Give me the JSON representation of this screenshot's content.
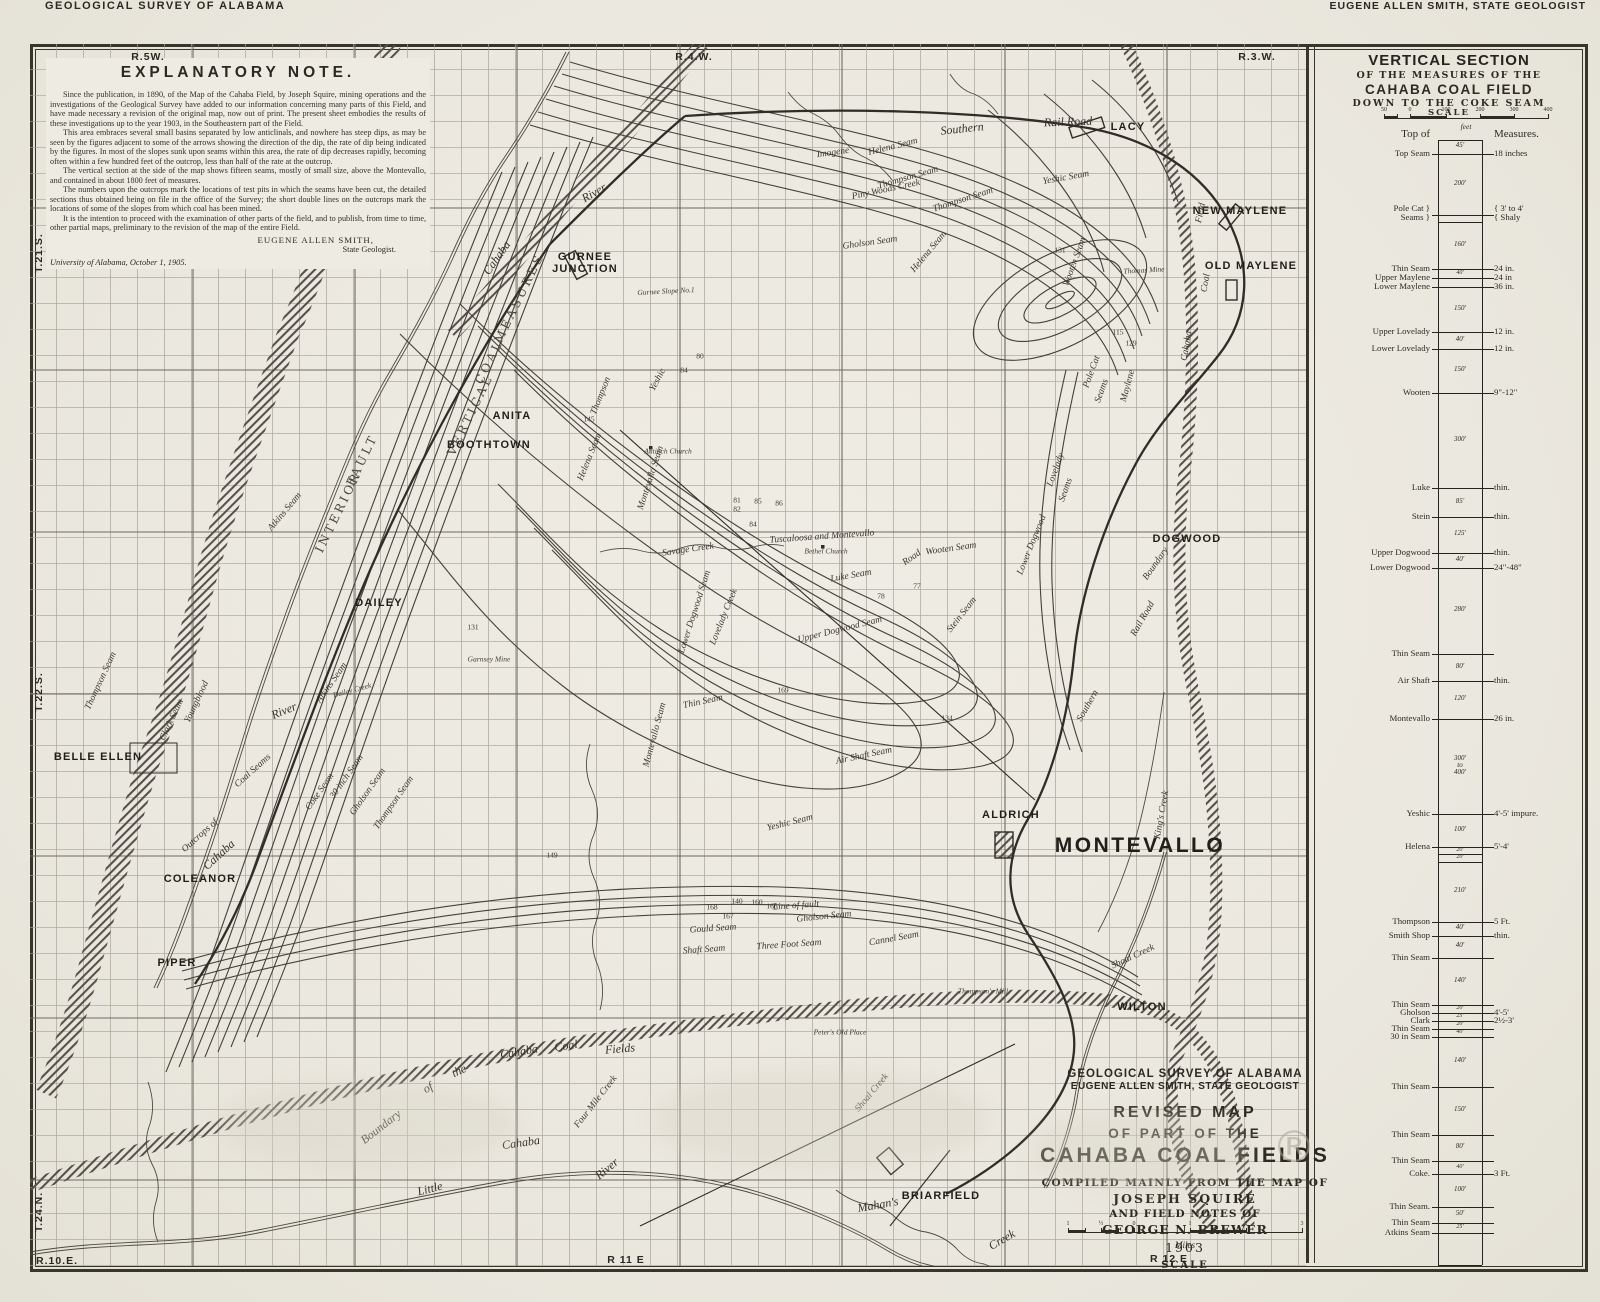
{
  "header": {
    "left": "GEOLOGICAL SURVEY OF ALABAMA",
    "right": "EUGENE ALLEN SMITH, STATE GEOLOGIST"
  },
  "explanatory_note": {
    "title": "EXPLANATORY NOTE.",
    "paragraphs": [
      "Since the publication, in 1890, of the Map of the Cahaba Field, by Joseph Squire, mining operations and the investigations of the Geological Survey have added to our information concerning many parts of this Field, and have made necessary a revision of the original map, now out of print.  The present sheet embodies the results of these investigations up to the year 1903, in the Southeastern part of the Field.",
      "This area embraces several small basins separated by low anticlinals, and nowhere has steep dips, as may be seen by the figures adjacent to some of the arrows showing the direction of the dip, the rate of dip being indicated by the figures.  In most of the slopes sunk upon seams within this area, the rate of dip decreases rapidly, becoming often within a few hundred feet of the outcrop, less than half of the rate at the outcrop.",
      "The vertical section at the side of the map shows fifteen seams, mostly of small size, above the Montevallo, and contained in about 1800 feet of measures.",
      "The numbers upon the outcrops mark the locations of test pits in which the seams have been cut, the detailed sections thus obtained being on file in the office of the Survey; the short double lines on the outcrops mark the locations of some of the slopes from which coal has been mined.",
      "It is the intention to proceed with the examination of other parts of the field, and to publish, from time to time, other partial maps, preliminary to the revision of the map of the entire Field."
    ],
    "signature": "EUGENE ALLEN SMITH,",
    "signature_title": "State Geologist.",
    "dateline": "University of Alabama, October 1, 1905."
  },
  "margin_labels": [
    {
      "t": "R.5W.",
      "x": 148,
      "y": 57,
      "r": 0
    },
    {
      "t": "R.4.W.",
      "x": 694,
      "y": 57,
      "r": 0
    },
    {
      "t": "R.3.W.",
      "x": 1257,
      "y": 57,
      "r": 0
    },
    {
      "t": "T.21.S.",
      "x": 39,
      "y": 253,
      "r": -90
    },
    {
      "t": "T.22.S.",
      "x": 39,
      "y": 692,
      "r": -90
    },
    {
      "t": "T.24.N.",
      "x": 39,
      "y": 1212,
      "r": -90
    },
    {
      "t": "R.10.E.",
      "x": 57,
      "y": 1261,
      "r": 0
    },
    {
      "t": "R 11 E",
      "x": 626,
      "y": 1260,
      "r": 0
    },
    {
      "t": "R 12 E",
      "x": 1169,
      "y": 1259,
      "r": 0
    }
  ],
  "towns": [
    {
      "t": "LACY",
      "x": 1128,
      "y": 127
    },
    {
      "t": "NEW MAYLENE",
      "x": 1240,
      "y": 211
    },
    {
      "t": "OLD MAYLENE",
      "x": 1251,
      "y": 266
    },
    {
      "t": "GURNEE\nJUNCTION",
      "x": 585,
      "y": 263
    },
    {
      "t": "ANITA",
      "x": 512,
      "y": 416
    },
    {
      "t": "BOOTHTOWN",
      "x": 489,
      "y": 445
    },
    {
      "t": "DAILEY",
      "x": 379,
      "y": 603
    },
    {
      "t": "BELLE ELLEN",
      "x": 98,
      "y": 757
    },
    {
      "t": "COLEANOR",
      "x": 200,
      "y": 879
    },
    {
      "t": "PIPER",
      "x": 177,
      "y": 963
    },
    {
      "t": "DOGWOOD",
      "x": 1187,
      "y": 539
    },
    {
      "t": "ALDRICH",
      "x": 1011,
      "y": 815
    },
    {
      "t": "MONTEVALLO",
      "x": 1140,
      "y": 846,
      "lg": true
    },
    {
      "t": "WILTON",
      "x": 1142,
      "y": 1007
    },
    {
      "t": "BRIARFIELD",
      "x": 941,
      "y": 1196
    }
  ],
  "features": [
    {
      "t": "Cahaba",
      "x": 497,
      "y": 258,
      "r": -55,
      "c": "il"
    },
    {
      "t": "River",
      "x": 594,
      "y": 193,
      "r": -30,
      "c": "il"
    },
    {
      "t": "Southern",
      "x": 962,
      "y": 129,
      "r": -6,
      "c": "il"
    },
    {
      "t": "Rail Road",
      "x": 1068,
      "y": 122,
      "r": -2,
      "c": "il"
    },
    {
      "t": "Helena Seam",
      "x": 893,
      "y": 147,
      "r": -14,
      "c": "i"
    },
    {
      "t": "Imogene",
      "x": 833,
      "y": 153,
      "r": -8,
      "c": "i"
    },
    {
      "t": "Thompson Seam",
      "x": 908,
      "y": 178,
      "r": -16,
      "c": "i"
    },
    {
      "t": "Piny Woods Creek",
      "x": 886,
      "y": 190,
      "r": -12,
      "c": "i"
    },
    {
      "t": "Yeshic Seam",
      "x": 1066,
      "y": 178,
      "r": -10,
      "c": "i"
    },
    {
      "t": "Thompson Seam",
      "x": 963,
      "y": 200,
      "r": -18,
      "c": "i"
    },
    {
      "t": "Helena Seam",
      "x": 929,
      "y": 252,
      "r": -50,
      "c": "i"
    },
    {
      "t": "Gholson Seam",
      "x": 870,
      "y": 243,
      "r": -8,
      "c": "i"
    },
    {
      "t": "Yeshic",
      "x": 658,
      "y": 380,
      "r": -62,
      "c": "i"
    },
    {
      "t": "Thompson",
      "x": 601,
      "y": 396,
      "r": -68,
      "c": "i"
    },
    {
      "t": "Helena Seam",
      "x": 590,
      "y": 457,
      "r": -68,
      "c": "i"
    },
    {
      "t": "Montevallo Seam",
      "x": 651,
      "y": 478,
      "r": -72,
      "c": "i"
    },
    {
      "t": "VERTICAL",
      "x": 470,
      "y": 415,
      "r": -64,
      "c": "cap"
    },
    {
      "t": "COAL",
      "x": 489,
      "y": 362,
      "r": -64,
      "c": "cap"
    },
    {
      "t": "MEASURES",
      "x": 519,
      "y": 298,
      "r": -64,
      "c": "cap"
    },
    {
      "t": "INTERIOR",
      "x": 338,
      "y": 512,
      "r": -64,
      "c": "cap"
    },
    {
      "t": "FAULT",
      "x": 362,
      "y": 460,
      "r": -64,
      "c": "cap"
    },
    {
      "t": "Tuscaloosa and Montevallo",
      "x": 822,
      "y": 537,
      "r": -4,
      "c": "i"
    },
    {
      "t": "Road",
      "x": 912,
      "y": 558,
      "r": -35,
      "c": "i"
    },
    {
      "t": "Savage Creek",
      "x": 688,
      "y": 550,
      "r": -8,
      "c": "i"
    },
    {
      "t": "Bethel Church",
      "x": 826,
      "y": 551,
      "r": 0,
      "c": "tn"
    },
    {
      "t": "Antioch Church",
      "x": 668,
      "y": 451,
      "r": 0,
      "c": "tn"
    },
    {
      "t": "Luke Seam",
      "x": 851,
      "y": 576,
      "r": -10,
      "c": "i"
    },
    {
      "t": "Wooten Seam",
      "x": 951,
      "y": 549,
      "r": -8,
      "c": "i"
    },
    {
      "t": "Stein Seam",
      "x": 962,
      "y": 615,
      "r": -52,
      "c": "i"
    },
    {
      "t": "Upper Dogwood Seam",
      "x": 840,
      "y": 630,
      "r": -14,
      "c": "i"
    },
    {
      "t": "Lower Dogwood Seam",
      "x": 695,
      "y": 612,
      "r": -72,
      "c": "i"
    },
    {
      "t": "Lovelady Creek",
      "x": 724,
      "y": 617,
      "r": -68,
      "c": "i"
    },
    {
      "t": "Montevallo Seam",
      "x": 655,
      "y": 735,
      "r": -75,
      "c": "i"
    },
    {
      "t": "Thin Seam",
      "x": 703,
      "y": 702,
      "r": -12,
      "c": "i"
    },
    {
      "t": "Air Shaft Seam",
      "x": 864,
      "y": 756,
      "r": -12,
      "c": "i"
    },
    {
      "t": "Yeshic Seam",
      "x": 790,
      "y": 823,
      "r": -14,
      "c": "i"
    },
    {
      "t": "King's Creek",
      "x": 1162,
      "y": 815,
      "r": -80,
      "c": "i"
    },
    {
      "t": "Shoal Creek",
      "x": 1133,
      "y": 957,
      "r": -25,
      "c": "i"
    },
    {
      "t": "Shoal Creek",
      "x": 872,
      "y": 1093,
      "r": -50,
      "c": "i"
    },
    {
      "t": "Mahan's",
      "x": 878,
      "y": 1205,
      "r": -10,
      "c": "il"
    },
    {
      "t": "Creek",
      "x": 1002,
      "y": 1240,
      "r": -30,
      "c": "il"
    },
    {
      "t": "Boundary",
      "x": 381,
      "y": 1127,
      "r": -38,
      "c": "il"
    },
    {
      "t": "of",
      "x": 428,
      "y": 1088,
      "r": -30,
      "c": "il"
    },
    {
      "t": "the",
      "x": 459,
      "y": 1071,
      "r": -25,
      "c": "il"
    },
    {
      "t": "Cahaba",
      "x": 519,
      "y": 1052,
      "r": -10,
      "c": "il"
    },
    {
      "t": "Coal",
      "x": 566,
      "y": 1046,
      "r": -8,
      "c": "il"
    },
    {
      "t": "Fields",
      "x": 620,
      "y": 1049,
      "r": -5,
      "c": "il"
    },
    {
      "t": "Little",
      "x": 430,
      "y": 1189,
      "r": -14,
      "c": "il"
    },
    {
      "t": "Cahaba",
      "x": 521,
      "y": 1143,
      "r": -8,
      "c": "il"
    },
    {
      "t": "River",
      "x": 607,
      "y": 1169,
      "r": -40,
      "c": "il"
    },
    {
      "t": "Four Mile Creek",
      "x": 596,
      "y": 1102,
      "r": -52,
      "c": "i"
    },
    {
      "t": "Outcrops of",
      "x": 200,
      "y": 836,
      "r": -42,
      "c": "i"
    },
    {
      "t": "Cahaba",
      "x": 219,
      "y": 855,
      "r": -42,
      "c": "il"
    },
    {
      "t": "Coal Seams",
      "x": 253,
      "y": 771,
      "r": -42,
      "c": "i"
    },
    {
      "t": "River",
      "x": 284,
      "y": 711,
      "r": -22,
      "c": "il"
    },
    {
      "t": "Field",
      "x": 1201,
      "y": 213,
      "r": -78,
      "c": "i"
    },
    {
      "t": "Coal",
      "x": 1206,
      "y": 283,
      "r": -80,
      "c": "i"
    },
    {
      "t": "Cahaba",
      "x": 1187,
      "y": 346,
      "r": -80,
      "c": "i"
    },
    {
      "t": "Boundary",
      "x": 1156,
      "y": 564,
      "r": -55,
      "c": "i"
    },
    {
      "t": "Rail Road",
      "x": 1143,
      "y": 619,
      "r": -60,
      "c": "i"
    },
    {
      "t": "Southern",
      "x": 1088,
      "y": 706,
      "r": -60,
      "c": "i"
    },
    {
      "t": "Gurnee Slope No.1",
      "x": 666,
      "y": 291,
      "r": -3,
      "c": "tn"
    },
    {
      "t": "Thomas Mine",
      "x": 1144,
      "y": 270,
      "r": -3,
      "c": "tn"
    },
    {
      "t": "Garnsey Mine",
      "x": 489,
      "y": 659,
      "r": 0,
      "c": "tn"
    },
    {
      "t": "Thompson's Mill",
      "x": 983,
      "y": 991,
      "r": 0,
      "c": "tn"
    },
    {
      "t": "Peter's Old Place",
      "x": 840,
      "y": 1032,
      "r": 0,
      "c": "tn"
    },
    {
      "t": "Line of fault",
      "x": 796,
      "y": 906,
      "r": -4,
      "c": "i"
    },
    {
      "t": "Gould Seam",
      "x": 713,
      "y": 929,
      "r": -4,
      "c": "i"
    },
    {
      "t": "Gholson Seam",
      "x": 824,
      "y": 917,
      "r": -6,
      "c": "i"
    },
    {
      "t": "Cannel Seam",
      "x": 894,
      "y": 939,
      "r": -10,
      "c": "i"
    },
    {
      "t": "Three Foot Seam",
      "x": 789,
      "y": 945,
      "r": -4,
      "c": "i"
    },
    {
      "t": "Shaft Seam",
      "x": 704,
      "y": 950,
      "r": -4,
      "c": "i"
    },
    {
      "t": "Atkins Seam",
      "x": 332,
      "y": 683,
      "r": -55,
      "c": "i"
    },
    {
      "t": "Dailey Creek",
      "x": 352,
      "y": 690,
      "r": -15,
      "c": "tn"
    },
    {
      "t": "Coke Seam",
      "x": 320,
      "y": 792,
      "r": -55,
      "c": "i"
    },
    {
      "t": "30 inch Seam",
      "x": 347,
      "y": 777,
      "r": -55,
      "c": "i"
    },
    {
      "t": "Gholson Seam",
      "x": 368,
      "y": 792,
      "r": -55,
      "c": "i"
    },
    {
      "t": "Thompson Seam",
      "x": 394,
      "y": 803,
      "r": -55,
      "c": "i"
    },
    {
      "t": "Clark Seam",
      "x": 172,
      "y": 720,
      "r": -65,
      "c": "i"
    },
    {
      "t": "Youngblood",
      "x": 197,
      "y": 702,
      "r": -65,
      "c": "i"
    },
    {
      "t": "Thompson Seam",
      "x": 101,
      "y": 681,
      "r": -65,
      "c": "i"
    },
    {
      "t": "Atkins Seam",
      "x": 285,
      "y": 512,
      "r": -50,
      "c": "i"
    },
    {
      "t": "Pole Cat",
      "x": 1092,
      "y": 372,
      "r": -70,
      "c": "i"
    },
    {
      "t": "Seams",
      "x": 1102,
      "y": 391,
      "r": -70,
      "c": "i"
    },
    {
      "t": "Maylene",
      "x": 1128,
      "y": 386,
      "r": -75,
      "c": "i"
    },
    {
      "t": "Lovelady",
      "x": 1056,
      "y": 470,
      "r": -70,
      "c": "i"
    },
    {
      "t": "Seams",
      "x": 1066,
      "y": 490,
      "r": -70,
      "c": "i"
    },
    {
      "t": "Lower Dogwood",
      "x": 1032,
      "y": 545,
      "r": -68,
      "c": "i"
    },
    {
      "t": "Wooten Seam",
      "x": 1075,
      "y": 262,
      "r": -70,
      "c": "i"
    }
  ],
  "numbers": [
    {
      "x": 737,
      "y": 500,
      "t": "81"
    },
    {
      "x": 737,
      "y": 509,
      "t": "82"
    },
    {
      "x": 758,
      "y": 501,
      "t": "85"
    },
    {
      "x": 779,
      "y": 503,
      "t": "86"
    },
    {
      "x": 753,
      "y": 524,
      "t": "84"
    },
    {
      "x": 917,
      "y": 586,
      "t": "77"
    },
    {
      "x": 881,
      "y": 596,
      "t": "78"
    },
    {
      "x": 783,
      "y": 690,
      "t": "169"
    },
    {
      "x": 589,
      "y": 419,
      "t": "145"
    },
    {
      "x": 473,
      "y": 627,
      "t": "131"
    },
    {
      "x": 1118,
      "y": 332,
      "t": "115"
    },
    {
      "x": 1131,
      "y": 343,
      "t": "129"
    },
    {
      "x": 947,
      "y": 718,
      "t": "134"
    },
    {
      "x": 552,
      "y": 855,
      "t": "149"
    },
    {
      "x": 737,
      "y": 901,
      "t": "140"
    },
    {
      "x": 712,
      "y": 907,
      "t": "168"
    },
    {
      "x": 772,
      "y": 906,
      "t": "166"
    },
    {
      "x": 728,
      "y": 916,
      "t": "167"
    },
    {
      "x": 757,
      "y": 902,
      "t": "160"
    },
    {
      "x": 1060,
      "y": 250,
      "t": "131"
    },
    {
      "x": 700,
      "y": 356,
      "t": "80"
    },
    {
      "x": 684,
      "y": 370,
      "t": "84"
    }
  ],
  "title_block": {
    "lines": [
      "GEOLOGICAL SURVEY OF ALABAMA",
      "EUGENE ALLEN SMITH, STATE GEOLOGIST",
      "REVISED MAP",
      "OF PART OF THE",
      "CAHABA COAL FIELDS",
      "COMPILED MAINLY FROM THE MAP OF",
      "JOSEPH SQUIRE",
      "AND FIELD NOTES OF",
      "GEORGE N. BREWER",
      "1903"
    ],
    "scale_label": "SCALE",
    "scale_unit": "Miles",
    "scale_ticks": [
      "1",
      "½",
      "0",
      "1",
      "2",
      "3"
    ]
  },
  "vertical_section": {
    "title1": "VERTICAL SECTION",
    "title2": "OF THE MEASURES OF THE",
    "title3": "CAHABA COAL FIELD",
    "title4": "DOWN TO THE COKE SEAM",
    "scale_label": "SCALE",
    "scale_unit": "feet",
    "scale_ticks": [
      "50",
      "0",
      "100",
      "200",
      "300",
      "400"
    ],
    "column_header_left": "Top of",
    "column_header_right": "Measures.",
    "rows": [
      {
        "y": 110,
        "n": "Top Seam",
        "i": "45'",
        "m": "18 inches"
      },
      {
        "y": 171,
        "n": "Pole Cat }",
        "n2": "Seams }",
        "i": "200'",
        "m": "{ 3' to 4'",
        "m2": "{ Shaly"
      },
      {
        "y": 178,
        "n": "",
        "i": "",
        "m": ""
      },
      {
        "y": 225,
        "n": "Thin Seam",
        "i": "160'",
        "m": "24 in."
      },
      {
        "y": 234,
        "n": "Upper Maylene",
        "i": "40'",
        "m": "24 in"
      },
      {
        "y": 243,
        "n": "Lower Maylene",
        "i": "",
        "m": "36 in."
      },
      {
        "y": 288,
        "n": "Upper Lovelady",
        "i": "150'",
        "m": "12 in."
      },
      {
        "y": 305,
        "n": "Lower Lovelady",
        "i": "40'",
        "m": "12 in."
      },
      {
        "y": 349,
        "n": "Wooten",
        "i": "150'",
        "m": "9\"-12\""
      },
      {
        "y": 444,
        "n": "Luke",
        "i": "300'",
        "m": "thin."
      },
      {
        "y": 473,
        "n": "Stein",
        "i": "85'",
        "m": "thin."
      },
      {
        "y": 509,
        "n": "Upper Dogwood",
        "i": "125'",
        "m": "thin."
      },
      {
        "y": 524,
        "n": "Lower Dogwood",
        "i": "40'",
        "m": "24\"-48\""
      },
      {
        "y": 610,
        "n": "Thin Seam",
        "i": "280'",
        "m": ""
      },
      {
        "y": 637,
        "n": "Air Shaft",
        "i": "80'",
        "m": "thin."
      },
      {
        "y": 675,
        "n": "Montevallo",
        "i": "120'",
        "m": "26 in."
      },
      {
        "y": 770,
        "n": "Yeshic",
        "i": "300'\nto\n400'",
        "m": "4'-5' impure."
      },
      {
        "y": 803,
        "n": "Helena",
        "i": "100'",
        "m": "5'-4'"
      },
      {
        "y": 810,
        "n": "",
        "i": "20'",
        "m": ""
      },
      {
        "y": 818,
        "n": "",
        "i": "20'",
        "m": ""
      },
      {
        "y": 878,
        "n": "Thompson",
        "i": "210'",
        "m": "5 Ft."
      },
      {
        "y": 892,
        "n": "Smith Shop",
        "i": "40'",
        "m": "thin."
      },
      {
        "y": 914,
        "n": "Thin Seam",
        "i": "40'",
        "m": ""
      },
      {
        "y": 961,
        "n": "Thin Seam",
        "i": "140'",
        "m": ""
      },
      {
        "y": 969,
        "n": "Gholson",
        "i": "20'",
        "m": "4'-5'"
      },
      {
        "y": 977,
        "n": "Clark",
        "i": "25'",
        "m": "2½-3'"
      },
      {
        "y": 985,
        "n": "Thin Seam",
        "i": "20'",
        "m": ""
      },
      {
        "y": 993,
        "n": "30 in Seam",
        "i": "40'",
        "m": ""
      },
      {
        "y": 1043,
        "n": "Thin Seam",
        "i": "140'",
        "m": ""
      },
      {
        "y": 1091,
        "n": "Thin Seam",
        "i": "150'",
        "m": ""
      },
      {
        "y": 1117,
        "n": "Thin Seam",
        "i": "80'",
        "m": ""
      },
      {
        "y": 1130,
        "n": "Coke.",
        "i": "40'",
        "m": "3 Ft."
      },
      {
        "y": 1163,
        "n": "Thin Seam.",
        "i": "100'",
        "m": ""
      },
      {
        "y": 1179,
        "n": "Thin Seam",
        "i": "50'",
        "m": ""
      },
      {
        "y": 1189,
        "n": "Atkins Seam",
        "i": "25'",
        "m": ""
      }
    ]
  },
  "watermark": "®"
}
